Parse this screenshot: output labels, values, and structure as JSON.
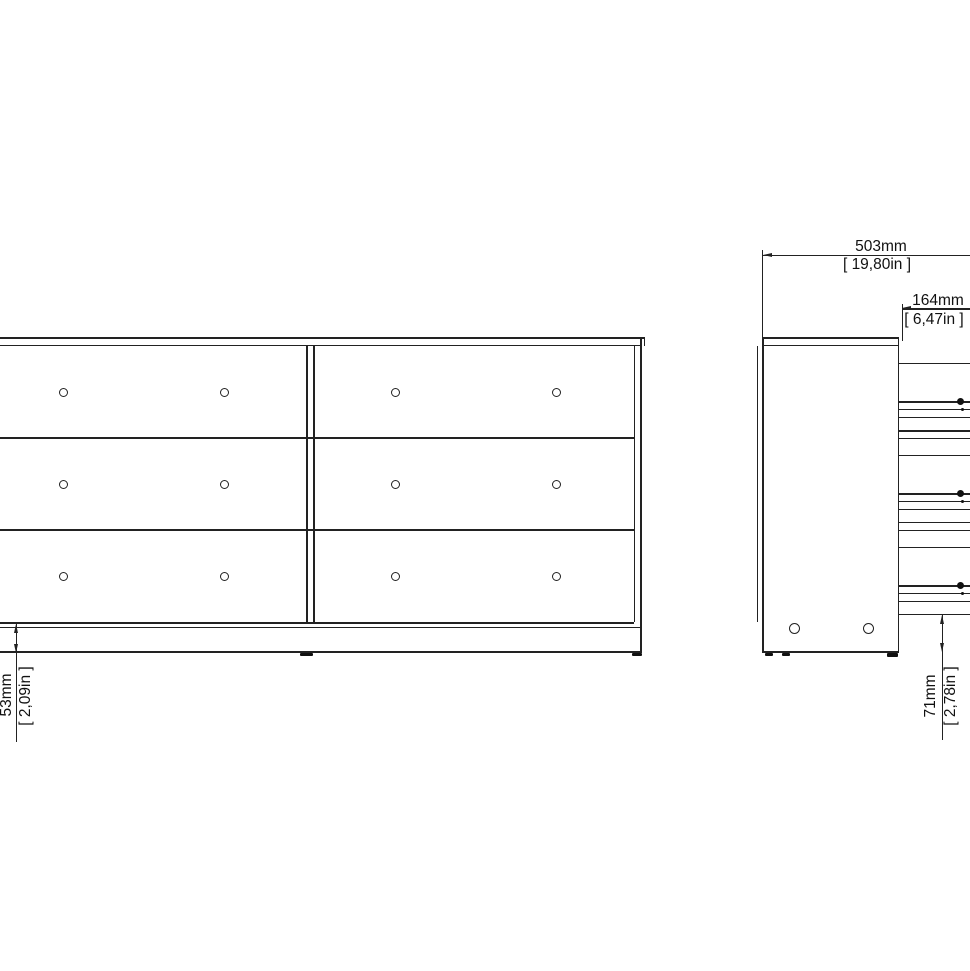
{
  "drawing": {
    "background": "#ffffff",
    "line_color": "#222222",
    "front_view": {
      "drawer_rows": 3,
      "drawer_columns": 2,
      "knobs_per_drawer": 2
    },
    "dimensions": {
      "depth": {
        "mm": "503mm",
        "in": "[ 19,80in ]"
      },
      "drawer_front_height": {
        "mm": "164mm",
        "in": "[ 6,47in ]"
      },
      "front_floor_clearance": {
        "mm": "53mm",
        "in": "[ 2,09in ]"
      },
      "side_floor_clearance": {
        "mm": "71mm",
        "in": "[ 2,78in ]"
      }
    }
  }
}
